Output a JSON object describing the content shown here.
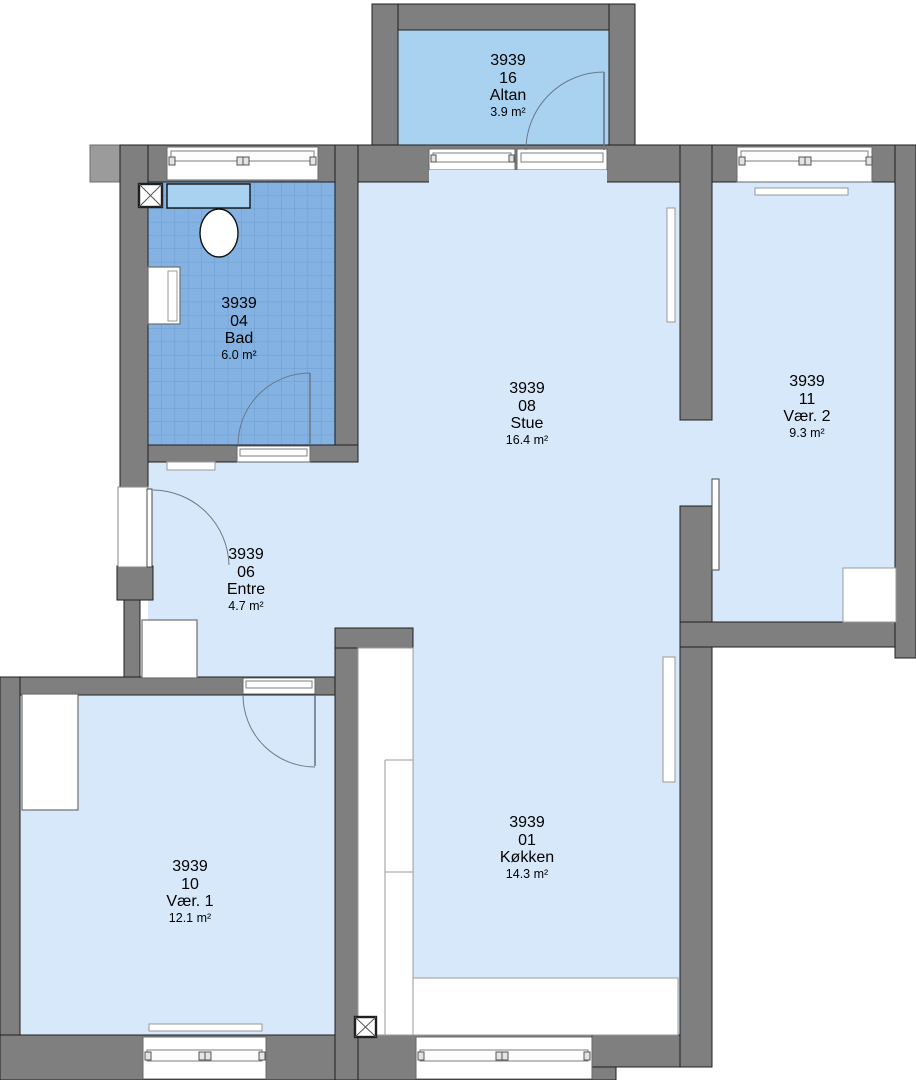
{
  "rooms": [
    {
      "id": "3939",
      "number": "16",
      "name": "Altan",
      "area": "3.9 m²"
    },
    {
      "id": "3939",
      "number": "04",
      "name": "Bad",
      "area": "6.0 m²"
    },
    {
      "id": "3939",
      "number": "08",
      "name": "Stue",
      "area": "16.4 m²"
    },
    {
      "id": "3939",
      "number": "11",
      "name": "Vær. 2",
      "area": "9.3 m²"
    },
    {
      "id": "3939",
      "number": "06",
      "name": "Entre",
      "area": "4.7 m²"
    },
    {
      "id": "3939",
      "number": "10",
      "name": "Vær. 1",
      "area": "12.1 m²"
    },
    {
      "id": "3939",
      "number": "01",
      "name": "Køkken",
      "area": "14.3 m²"
    }
  ],
  "icons": {
    "shaft_marker": "x-box"
  },
  "colors": {
    "wall": "#7f7f7f",
    "wall_outline": "#1f1f1f",
    "floor": "#d7e8fa",
    "balcony_floor": "#a9d2f1",
    "bath_tile": "#84b3e3",
    "bath_tile_line": "#6b9bd0",
    "door_line": "#6b7888",
    "fixture": "#ffffff",
    "text": "#000000"
  }
}
